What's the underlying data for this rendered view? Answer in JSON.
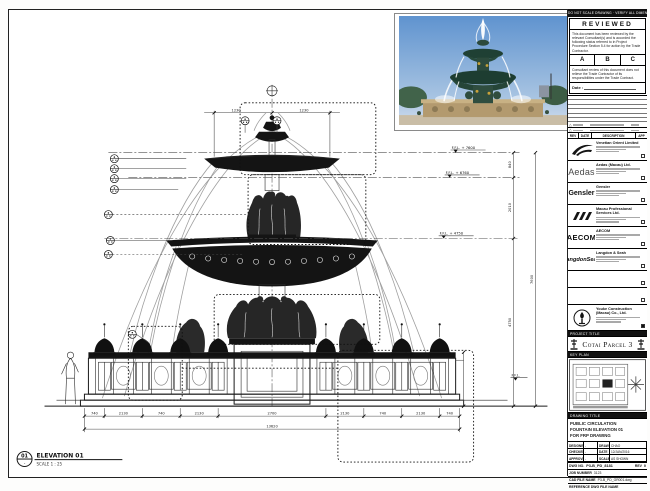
{
  "sheet": {
    "top_note": "DO NOT SCALE DRAWING · VERIFY ALL DIMENSIONS ON SITE",
    "stamp": {
      "title": "REVIEWED",
      "body1": "This document has been reviewed by the relevant Consultant(s) and is accorded the following status referred to in Project Procedure Section 5.4 for action by the Trade Contractor.",
      "grade_a": "A",
      "grade_b": "B",
      "grade_c": "C",
      "body2": "Consultant review of this document does not relieve the Trade Contractor of its responsibilities under the Trade Contract.",
      "date_label": "Date :"
    },
    "rev_header": {
      "rev": "REV",
      "date": "DATE",
      "desc": "DESCRIPTION",
      "app": "APP"
    },
    "consultants": [
      {
        "wordmark": "",
        "name": "Venetian Orient Limited"
      },
      {
        "wordmark": "Aedas",
        "name": "Aedas (Macau) Ltd."
      },
      {
        "wordmark": "Gensler",
        "name": "Gensler"
      },
      {
        "wordmark": "",
        "name": "Macau Professional Services Ltd."
      },
      {
        "wordmark": "AECOM",
        "name": "AECOM"
      },
      {
        "wordmark": "LangdonSeah",
        "name": "Langdon & Seah"
      }
    ],
    "contractor_name": "Youke Construction (Macau) Co., Ltd.",
    "project_title_label": "PROJECT TITLE",
    "project_title": "Cotai Parcel 3",
    "key_plan_label": "KEY PLAN",
    "drawing_title_label": "DRAWING TITLE",
    "drawing_title_line1": "PUBLIC  CIRCULATION",
    "drawing_title_line2": "FOUNTAIN ELEVATION 01",
    "drawing_title_line3": "FOR FRP DRAWING",
    "sign": {
      "designed_label": "DESIGNED",
      "designed": "-",
      "drawn_label": "DRAWN",
      "drawn": "CHAO",
      "checked_label": "CHECKED",
      "checked": "-",
      "date_label": "DATE",
      "date": "12/JAN/2016",
      "approved_label": "APPROVED",
      "approved": "-",
      "scale_label": "SCALE",
      "scale": "AS SHOWN"
    },
    "dwg_no_label": "DWG NO.",
    "dwg_no": "P3-B_PD_8181",
    "rev_label": "REV",
    "rev_no": "0",
    "job_label": "JOB NUMBER",
    "job_no": "3123",
    "cad_label": "CAD FILE NAME",
    "cad_file": "P3-B_PD_GR001.dwg",
    "ref_label": "REFERENCE DWG FILE NAME"
  },
  "drawing": {
    "elevation_tag": "01",
    "elevation_label": "ELEVATION 01",
    "scale_note": "SCALE  1 : 25",
    "levels": [
      "F.F.L. + 7600",
      "F.F.L. + 6760",
      "F.F.L. + 4750",
      "F.F.L."
    ],
    "dims": {
      "top_left": "1230",
      "top_right": "1230",
      "right_1": "840",
      "right_2": "2010",
      "right_3": "4750",
      "right_overall": "7600",
      "bottom_overall": "13620",
      "bottom": [
        "740",
        "2130",
        "740",
        "2130",
        "2700",
        "2130",
        "740",
        "2130",
        "740"
      ]
    }
  }
}
